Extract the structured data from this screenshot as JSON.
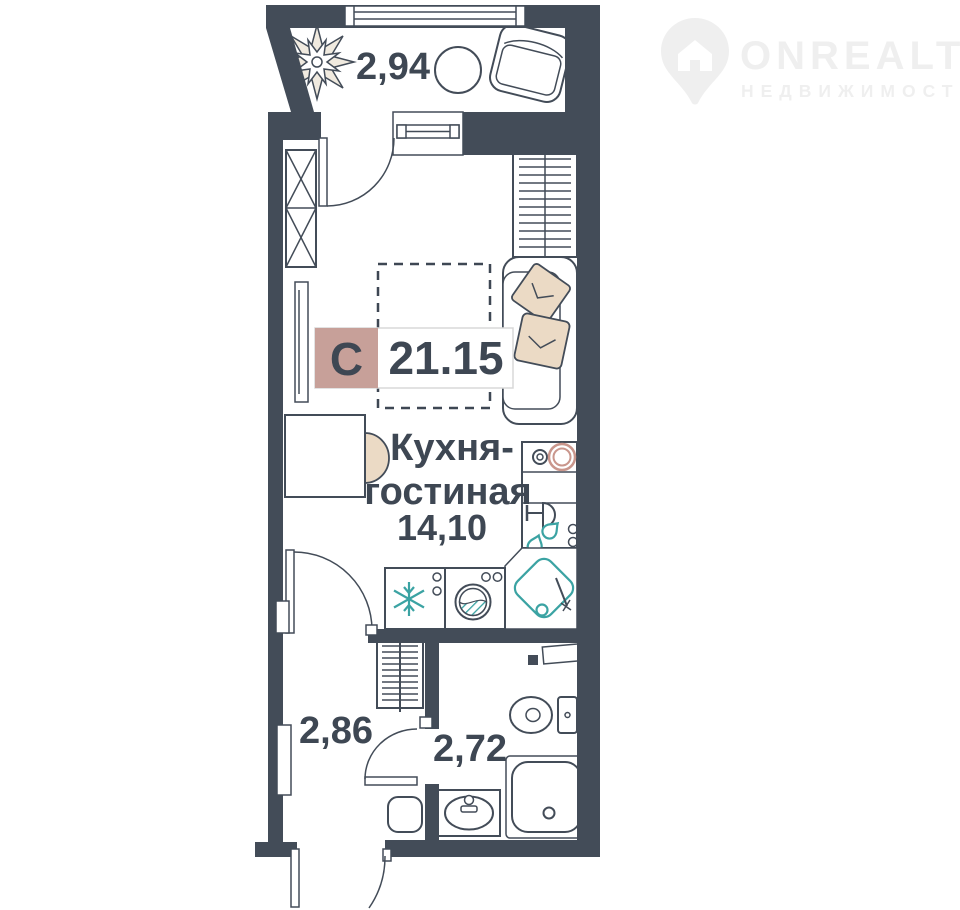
{
  "watermark": {
    "brand": "ONREALT",
    "tagline": "НЕДВИЖИМОСТЬ"
  },
  "badge": {
    "type_letter": "С",
    "total_area": "21.15"
  },
  "rooms": {
    "balcony": {
      "area": "2,94"
    },
    "kitchen_living": {
      "name_line1": "Кухня-",
      "name_line2": "гостиная",
      "area": "14,10"
    },
    "hallway": {
      "area": "2,86"
    },
    "bathroom": {
      "area": "2,72"
    }
  },
  "colors": {
    "wall": "#434C58",
    "text": "#3E4753",
    "badge_pink": "#C7A099",
    "badge_border": "#D8D8D8",
    "plumbing_teal": "#3BA3A3",
    "furniture_beige": "#EBDAC5",
    "stove_ring": "#C9968C",
    "watermark": "#EFEFEF"
  }
}
